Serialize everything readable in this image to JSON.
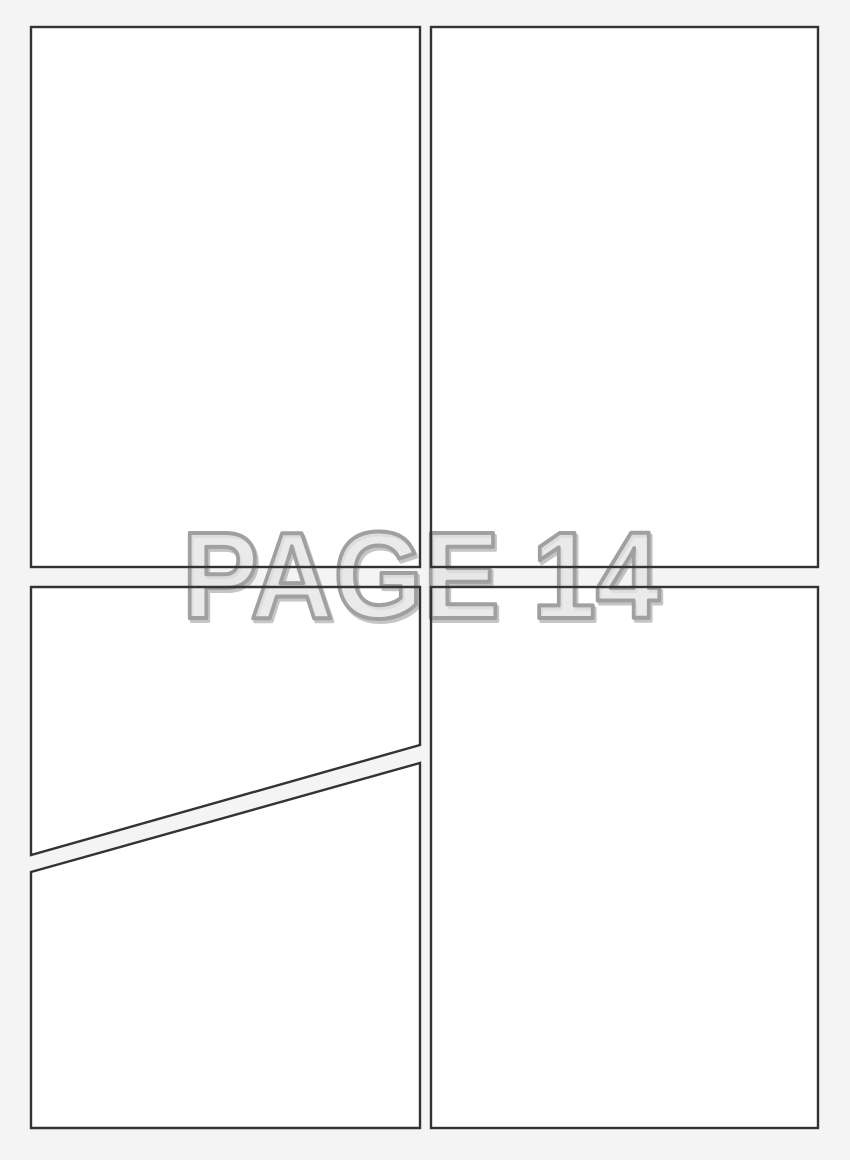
{
  "page": {
    "label": "PAGE 14",
    "panels": [
      {
        "name": "top-left",
        "shape": "rectangle"
      },
      {
        "name": "top-right",
        "shape": "rectangle"
      },
      {
        "name": "bottom-left-upper",
        "shape": "diagonal-cut"
      },
      {
        "name": "bottom-left-lower",
        "shape": "diagonal-cut"
      },
      {
        "name": "bottom-right",
        "shape": "rectangle"
      }
    ]
  },
  "colors": {
    "background": "#f4f4f4",
    "panel_fill": "#ffffff",
    "panel_border": "#333333",
    "label_outline": "#a0a0a0",
    "label_fill_rgba": "rgba(243,243,243,0.55)",
    "label_shadow_rgba": "rgba(140,140,140,0.5)"
  }
}
